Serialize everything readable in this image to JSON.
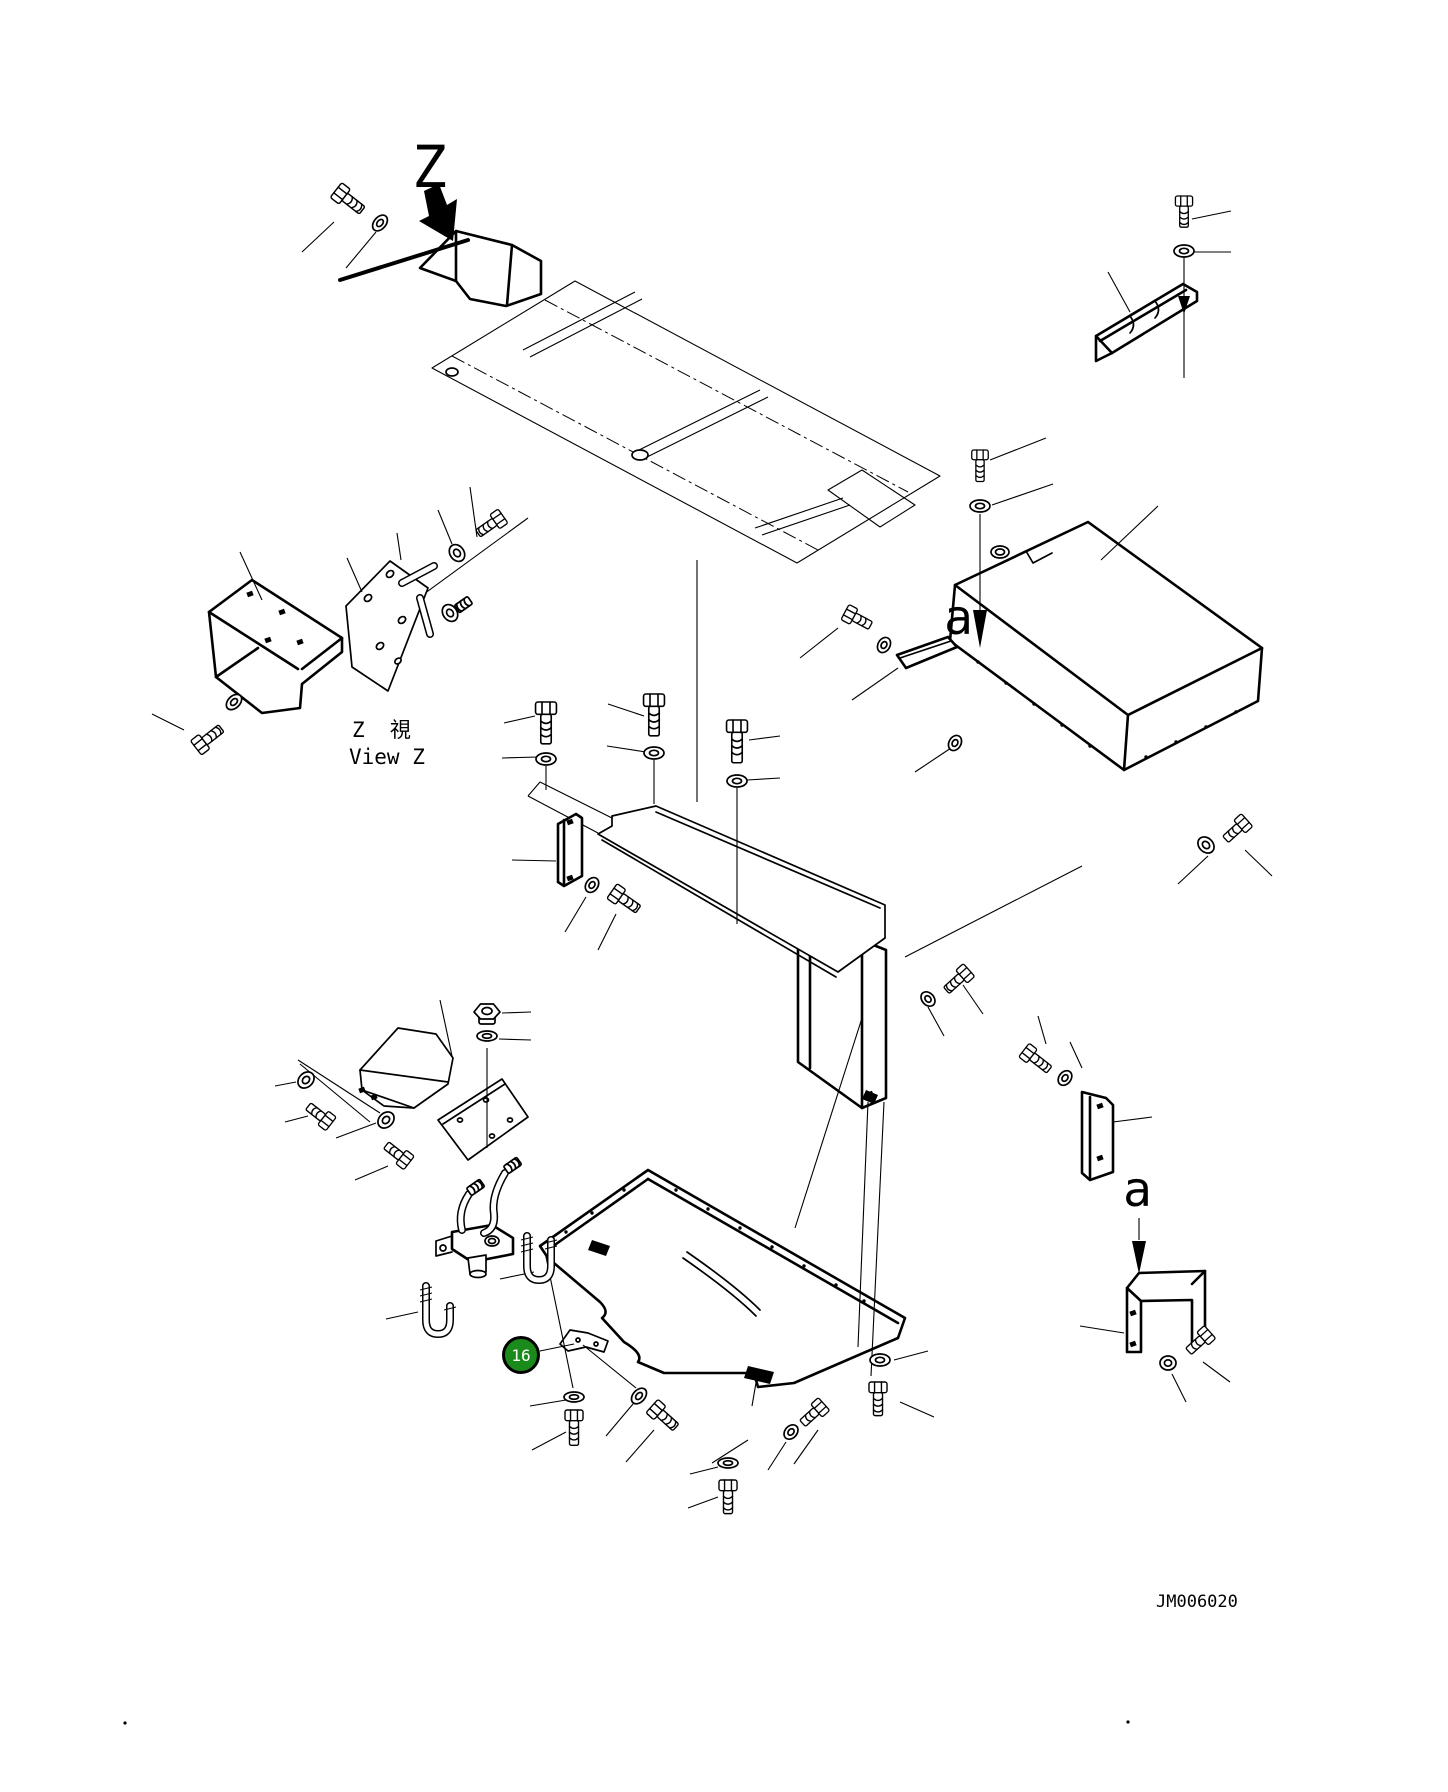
{
  "page": {
    "width": 1448,
    "height": 1792,
    "background": "#ffffff",
    "ink": "#000000"
  },
  "labels": {
    "z_marker": {
      "text": "Z",
      "x": 412,
      "y": 138,
      "size": 58
    },
    "view_caption_cjk": {
      "text": "Z  視",
      "x": 352,
      "y": 720,
      "size": 21
    },
    "view_caption_en": {
      "text": "View Z",
      "x": 349,
      "y": 747,
      "size": 21
    },
    "a1": {
      "text": "a",
      "x": 944,
      "y": 594,
      "size": 48
    },
    "a2": {
      "text": "a",
      "x": 1123,
      "y": 1166,
      "size": 48
    },
    "code": {
      "text": "JM006020",
      "x": 1156,
      "y": 1594,
      "size": 17
    }
  },
  "callout": {
    "number": "16",
    "cx": 521,
    "cy": 1355,
    "r": 19,
    "fill": "#1a8a1a",
    "ring": "#000000",
    "text_color": "#ffffff"
  },
  "colors": {
    "highlight_green": "#1a8a1a",
    "ink": "#000000",
    "paper": "#ffffff"
  },
  "diagram": {
    "heavy": [
      "M420,268 L456,231 L512,245 L541,261 L541,294 L506,306 L470,299 L456,281 Z",
      "M456,231 L456,281",
      "M512,245 L507,305",
      "M209,612 L252,580 L342,638 L342,652 L302,684 L300,708 L262,713 L216,677 Z",
      "M209,612 L298,669",
      "M342,638 L302,669",
      "M216,677 L258,648",
      "M1096,336 L1183,284 L1197,292 L1197,301 L1112,353 L1096,361 Z",
      "M1100,341 L1186,290",
      "M1096,336 L1112,353",
      "M955,585 L1088,522 L1262,648 L1258,701 L1124,770 L950,641 Z",
      "M955,585 L1128,715",
      "M1128,715 L1262,648",
      "M1128,715 L1124,770",
      "M897,655 L948,637 L957,647 L906,668 Z",
      "M558,824 L576,814 L582,818 L582,876 L564,886 L558,882 Z",
      "M564,820 L564,884",
      "M798,915 L886,950 L886,1098 L862,1108 L798,1062 Z",
      "M810,920 L810,1068",
      "M862,941 L862,1108",
      "M648,1170 L540,1246 L548,1258 L600,1302 Q610,1312 602,1318 L624,1342 Q644,1354 638,1362 L664,1373 L754,1373 L758,1387 L794,1383 L898,1338 L905,1318 Z",
      "M648,1179 L898,1323",
      "M648,1179 L549,1249",
      "M1127,1352 L1127,1288 L1139,1273 L1205,1271 L1205,1340 L1192,1352 L1192,1300 L1141,1301 L1141,1352 Z",
      "M1127,1288 L1141,1301",
      "M1205,1271 L1192,1284",
      "M1082,1092 L1106,1098 L1113,1105 L1113,1172 L1090,1180 L1082,1173 Z",
      "M1090,1097 L1090,1179",
      "M452,1232 L492,1225 L513,1238 L513,1254 L472,1262 L452,1249 Z"
    ],
    "med": [
      "M1130,316 Q1137,325 1130,333",
      "M1155,301 Q1162,310 1155,318",
      "M900,658 L951,641",
      "M346,606 L390,561 L428,588 L388,691 L352,667 Z",
      "M656,806 L885,905 L885,938 L838,972 L598,834 L612,826 L612,816 Z",
      "M656,812 L880,908",
      "M602,840 L836,977",
      "M687,1252 Q736,1286 760,1310",
      "M683,1258 Q732,1292 756,1316",
      "M560,1344 L570,1330 L588,1333 L608,1341 L604,1352 L586,1347 L568,1351 Z",
      "M360,1070 L398,1028 L436,1034 L453,1058 L448,1084 L414,1108 L384,1106 L362,1090 Z",
      "M360,1070 L448,1082",
      "M362,1090 L414,1108",
      "M438,1120 L502,1079 L528,1117 L468,1160 Z",
      "M443,1124 L505,1084",
      "M468,1258 L486,1255 L486,1272 L470,1274 Z",
      "M452,1236 L436,1241 L436,1256 L452,1252",
      "M1004,562 L1026,551 L1033,563 L1052,553"
    ],
    "thin": [
      "M432,368 L575,281 L940,476 L797,563 Z",
      "M523,350 L635,292",
      "M530,357 L642,299",
      "M635,452 L760,390",
      "M643,459 L768,397",
      "M755,528 L843,498",
      "M762,535 L850,505",
      "M828,490 L862,470 L915,505 L880,527 Z",
      "M350,648 L528,518",
      "M612,818 L540,782",
      "M598,833 L528,796",
      "M540,782 L528,796",
      "M590,1230 L793,1350",
      "M612,1227 L793,1313",
      "M640,830 L850,925"
    ],
    "dashdot": [
      "M452,356 L818,550",
      "M545,300 L908,492"
    ],
    "thick": [
      "M340,280 L468,240"
    ],
    "darkpolys": [
      "424,191 439,184 447,205 457,199 453,241 419,221 429,216",
      "973,610 987,610 980,648",
      "1132,1241 1146,1241 1139,1274",
      "1178,296 1190,296 1184,314",
      "748,1366 774,1372 770,1384 744,1378",
      "592,1240 610,1246 606,1256 588,1250",
      "866,1090 878,1095 874,1104 862,1099"
    ],
    "darksquares": [
      [
        250,
        594
      ],
      [
        282,
        612
      ],
      [
        300,
        642
      ],
      [
        268,
        640
      ],
      [
        570,
        822
      ],
      [
        570,
        878
      ],
      [
        1100,
        1106
      ],
      [
        1100,
        1158
      ],
      [
        362,
        1090
      ],
      [
        374,
        1097
      ],
      [
        870,
        1094
      ],
      [
        1133,
        1313
      ],
      [
        1133,
        1344
      ]
    ],
    "dots": [
      [
        125,
        1723
      ],
      [
        1128,
        1722
      ]
    ],
    "rivets": [
      [
        676,
        1190
      ],
      [
        708,
        1209
      ],
      [
        740,
        1228
      ],
      [
        772,
        1247
      ],
      [
        804,
        1266
      ],
      [
        836,
        1285
      ],
      [
        864,
        1301
      ],
      [
        624,
        1190
      ],
      [
        592,
        1213
      ],
      [
        566,
        1232
      ],
      [
        978,
        662
      ],
      [
        1006,
        683
      ],
      [
        1034,
        704
      ],
      [
        1062,
        725
      ],
      [
        1090,
        746
      ],
      [
        1146,
        757
      ],
      [
        1176,
        742
      ],
      [
        1206,
        727
      ],
      [
        1236,
        712
      ]
    ],
    "ellipses": [
      [
        1000,
        552,
        9,
        6,
        0
      ],
      [
        1000,
        552,
        4.5,
        3,
        0
      ],
      [
        368,
        598,
        4,
        3,
        -40
      ],
      [
        390,
        574,
        4,
        3,
        -40
      ],
      [
        402,
        620,
        4,
        3,
        -40
      ],
      [
        380,
        646,
        4,
        3,
        -40
      ],
      [
        398,
        661,
        3.5,
        2.5,
        -40
      ],
      [
        640,
        455,
        8,
        5,
        0
      ],
      [
        452,
        372,
        6,
        4,
        0
      ],
      [
        492,
        1241,
        7,
        5,
        0
      ],
      [
        492,
        1241,
        3.5,
        2.5,
        0
      ],
      [
        478,
        1274,
        8,
        3.5,
        0
      ],
      [
        443,
        1248,
        3,
        3,
        0
      ],
      [
        578,
        1340,
        2,
        2,
        0
      ],
      [
        596,
        1344,
        2,
        2,
        0
      ],
      [
        460,
        1120,
        2.5,
        2,
        0
      ],
      [
        486,
        1100,
        2.5,
        2,
        0
      ],
      [
        492,
        1136,
        2.5,
        2,
        0
      ],
      [
        510,
        1120,
        2.5,
        2,
        0
      ]
    ],
    "leaders": [
      [
        302,
        252,
        334,
        222
      ],
      [
        346,
        268,
        376,
        232
      ],
      [
        1192,
        219,
        1231,
        211
      ],
      [
        1193,
        252,
        1231,
        252
      ],
      [
        1184,
        257,
        1184,
        378
      ],
      [
        1108,
        272,
        1130,
        312
      ],
      [
        990,
        460,
        1046,
        438
      ],
      [
        992,
        505,
        1053,
        484
      ],
      [
        980,
        514,
        980,
        610
      ],
      [
        1101,
        560,
        1158,
        506
      ],
      [
        838,
        628,
        800,
        658
      ],
      [
        852,
        700,
        898,
        668
      ],
      [
        915,
        772,
        951,
        748
      ],
      [
        1208,
        856,
        1178,
        884
      ],
      [
        1245,
        850,
        1272,
        876
      ],
      [
        240,
        552,
        262,
        600
      ],
      [
        347,
        558,
        362,
        592
      ],
      [
        397,
        533,
        401,
        560
      ],
      [
        438,
        510,
        452,
        544
      ],
      [
        470,
        487,
        477,
        537
      ],
      [
        152,
        714,
        184,
        730
      ],
      [
        504,
        723,
        535,
        716
      ],
      [
        502,
        758,
        538,
        757
      ],
      [
        608,
        704,
        644,
        716
      ],
      [
        607,
        746,
        646,
        752
      ],
      [
        749,
        740,
        780,
        736
      ],
      [
        747,
        780,
        780,
        778
      ],
      [
        546,
        766,
        546,
        790
      ],
      [
        654,
        760,
        654,
        804
      ],
      [
        737,
        788,
        737,
        924
      ],
      [
        697,
        560,
        697,
        802
      ],
      [
        512,
        860,
        556,
        861
      ],
      [
        565,
        932,
        586,
        897
      ],
      [
        598,
        950,
        616,
        914
      ],
      [
        862,
        1018,
        795,
        1228
      ],
      [
        868,
        1102,
        858,
        1347
      ],
      [
        884,
        1102,
        871,
        1376
      ],
      [
        905,
        957,
        1082,
        866
      ],
      [
        928,
        1007,
        944,
        1036
      ],
      [
        963,
        985,
        983,
        1014
      ],
      [
        1038,
        1016,
        1046,
        1044
      ],
      [
        1070,
        1042,
        1082,
        1068
      ],
      [
        1113,
        1122,
        1152,
        1117
      ],
      [
        1080,
        1326,
        1124,
        1333
      ],
      [
        1172,
        1374,
        1186,
        1402
      ],
      [
        1203,
        1362,
        1230,
        1382
      ],
      [
        1139,
        1218,
        1139,
        1240
      ],
      [
        545,
        1252,
        573,
        1388
      ],
      [
        583,
        1345,
        636,
        1388
      ],
      [
        757,
        1377,
        752,
        1406
      ],
      [
        566,
        1400,
        530,
        1406
      ],
      [
        566,
        1432,
        532,
        1450
      ],
      [
        633,
        1404,
        606,
        1436
      ],
      [
        654,
        1430,
        626,
        1462
      ],
      [
        748,
        1440,
        712,
        1463
      ],
      [
        786,
        1442,
        768,
        1470
      ],
      [
        818,
        1430,
        794,
        1464
      ],
      [
        894,
        1360,
        928,
        1351
      ],
      [
        900,
        1402,
        934,
        1417
      ],
      [
        718,
        1467,
        690,
        1474
      ],
      [
        718,
        1497,
        688,
        1508
      ],
      [
        534,
        1272,
        500,
        1279
      ],
      [
        418,
        1312,
        386,
        1319
      ],
      [
        502,
        1013,
        531,
        1012
      ],
      [
        499,
        1039,
        531,
        1040
      ],
      [
        440,
        1000,
        452,
        1056
      ],
      [
        275,
        1086,
        296,
        1082
      ],
      [
        285,
        1122,
        308,
        1116
      ],
      [
        336,
        1138,
        376,
        1123
      ],
      [
        355,
        1180,
        388,
        1166
      ],
      [
        298,
        1060,
        380,
        1113
      ],
      [
        300,
        1064,
        370,
        1122
      ],
      [
        487,
        1048,
        487,
        1148
      ],
      [
        540,
        1351,
        574,
        1344
      ]
    ],
    "bolts": [
      {
        "x": 336,
        "y": 190,
        "rot": -52,
        "len": 26,
        "s": 0.85
      },
      {
        "x": 1184,
        "y": 196,
        "rot": 0,
        "len": 27,
        "s": 0.78
      },
      {
        "x": 980,
        "y": 450,
        "rot": 0,
        "len": 29,
        "s": 0.75
      },
      {
        "x": 845,
        "y": 612,
        "rot": -62,
        "len": 24,
        "s": 0.78
      },
      {
        "x": 1247,
        "y": 820,
        "rot": 48,
        "len": 24,
        "s": 0.78
      },
      {
        "x": 546,
        "y": 702,
        "rot": 0,
        "len": 31,
        "s": 0.95
      },
      {
        "x": 654,
        "y": 694,
        "rot": 0,
        "len": 31,
        "s": 0.95
      },
      {
        "x": 737,
        "y": 720,
        "rot": 0,
        "len": 32,
        "s": 0.95
      },
      {
        "x": 612,
        "y": 891,
        "rot": -55,
        "len": 26,
        "s": 0.82
      },
      {
        "x": 503,
        "y": 516,
        "rot": 55,
        "len": 26,
        "s": 0.78
      },
      {
        "x": 196,
        "y": 748,
        "rot": -128,
        "len": 26,
        "s": 0.82
      },
      {
        "x": 331,
        "y": 1124,
        "rot": 128,
        "len": 24,
        "s": 0.78
      },
      {
        "x": 409,
        "y": 1163,
        "rot": 128,
        "len": 24,
        "s": 0.78
      },
      {
        "x": 969,
        "y": 970,
        "rot": 48,
        "len": 26,
        "s": 0.78
      },
      {
        "x": 1024,
        "y": 1050,
        "rot": -52,
        "len": 28,
        "s": 0.78
      },
      {
        "x": 1210,
        "y": 1332,
        "rot": 48,
        "len": 24,
        "s": 0.78
      },
      {
        "x": 878,
        "y": 1382,
        "rot": 0,
        "len": 28,
        "s": 0.82
      },
      {
        "x": 574,
        "y": 1410,
        "rot": 0,
        "len": 30,
        "s": 0.82
      },
      {
        "x": 652,
        "y": 1406,
        "rot": -48,
        "len": 26,
        "s": 0.82
      },
      {
        "x": 824,
        "y": 1404,
        "rot": 48,
        "len": 24,
        "s": 0.78
      },
      {
        "x": 728,
        "y": 1480,
        "rot": 0,
        "len": 28,
        "s": 0.82
      }
    ],
    "washers": [
      {
        "x": 380,
        "y": 223,
        "rx": 9,
        "ry": 6,
        "rot": -50
      },
      {
        "x": 1184,
        "y": 251,
        "rx": 10,
        "ry": 6,
        "rot": 0
      },
      {
        "x": 980,
        "y": 506,
        "rx": 10,
        "ry": 6,
        "rot": 0
      },
      {
        "x": 884,
        "y": 645,
        "rx": 8,
        "ry": 6,
        "rot": -60
      },
      {
        "x": 955,
        "y": 743,
        "rx": 8,
        "ry": 6,
        "rot": -60
      },
      {
        "x": 1206,
        "y": 845,
        "rx": 9,
        "ry": 7,
        "rot": 45
      },
      {
        "x": 546,
        "y": 759,
        "rx": 10,
        "ry": 6,
        "rot": 0
      },
      {
        "x": 654,
        "y": 753,
        "rx": 10,
        "ry": 6,
        "rot": 0
      },
      {
        "x": 737,
        "y": 781,
        "rx": 10,
        "ry": 6,
        "rot": 0
      },
      {
        "x": 457,
        "y": 553,
        "rx": 9,
        "ry": 7,
        "rot": 55
      },
      {
        "x": 450,
        "y": 613,
        "rx": 9,
        "ry": 7,
        "rot": 55
      },
      {
        "x": 234,
        "y": 702,
        "rx": 9,
        "ry": 6,
        "rot": -45
      },
      {
        "x": 592,
        "y": 885,
        "rx": 8,
        "ry": 6,
        "rot": -55
      },
      {
        "x": 306,
        "y": 1080,
        "rx": 9,
        "ry": 7,
        "rot": -45
      },
      {
        "x": 386,
        "y": 1120,
        "rx": 9,
        "ry": 7,
        "rot": -45
      },
      {
        "x": 487,
        "y": 1036,
        "rx": 10,
        "ry": 5,
        "rot": 0
      },
      {
        "x": 928,
        "y": 999,
        "rx": 8,
        "ry": 6,
        "rot": 48
      },
      {
        "x": 1065,
        "y": 1078,
        "rx": 8,
        "ry": 6,
        "rot": -52
      },
      {
        "x": 1168,
        "y": 1363,
        "rx": 8,
        "ry": 7,
        "rot": 0
      },
      {
        "x": 880,
        "y": 1360,
        "rx": 10,
        "ry": 6,
        "rot": 0
      },
      {
        "x": 574,
        "y": 1397,
        "rx": 10,
        "ry": 5,
        "rot": 0
      },
      {
        "x": 639,
        "y": 1396,
        "rx": 9,
        "ry": 6,
        "rot": -48
      },
      {
        "x": 791,
        "y": 1432,
        "rx": 8,
        "ry": 6,
        "rot": -48
      },
      {
        "x": 728,
        "y": 1463,
        "rx": 10,
        "ry": 5,
        "rot": 0
      }
    ],
    "nuts": [
      {
        "x": 487,
        "y": 1008
      }
    ],
    "pins": [
      {
        "x1": 402,
        "y1": 583,
        "x2": 434,
        "y2": 566
      },
      {
        "x1": 420,
        "y1": 598,
        "x2": 430,
        "y2": 634
      }
    ],
    "fittings": [
      {
        "x": 506,
        "y": 1170,
        "rot": -125
      },
      {
        "x": 469,
        "y": 1192,
        "rot": -125
      },
      {
        "x": 470,
        "y": 600,
        "rot": 55
      }
    ],
    "tubes": [
      "M505,1173 C496,1188 492,1202 494,1214 C495,1226 490,1231 484,1233",
      "M469,1194 C461,1206 459,1218 462,1230"
    ],
    "ubolts": [
      {
        "d": "M527,1236 L527,1266 Q527,1280 539,1280 Q551,1280 551,1266 L551,1240",
        "ticks": [
          [
            521,
            1240,
            533,
            1237
          ],
          [
            521,
            1246,
            533,
            1243
          ],
          [
            521,
            1252,
            533,
            1249
          ],
          [
            545,
            1243,
            557,
            1240
          ],
          [
            545,
            1249,
            557,
            1246
          ]
        ]
      },
      {
        "d": "M426,1286 L426,1320 Q426,1334 438,1334 Q450,1334 450,1320 L450,1306",
        "ticks": [
          [
            420,
            1290,
            432,
            1287
          ],
          [
            420,
            1296,
            432,
            1293
          ],
          [
            420,
            1302,
            432,
            1299
          ],
          [
            444,
            1310,
            456,
            1307
          ]
        ]
      }
    ]
  }
}
